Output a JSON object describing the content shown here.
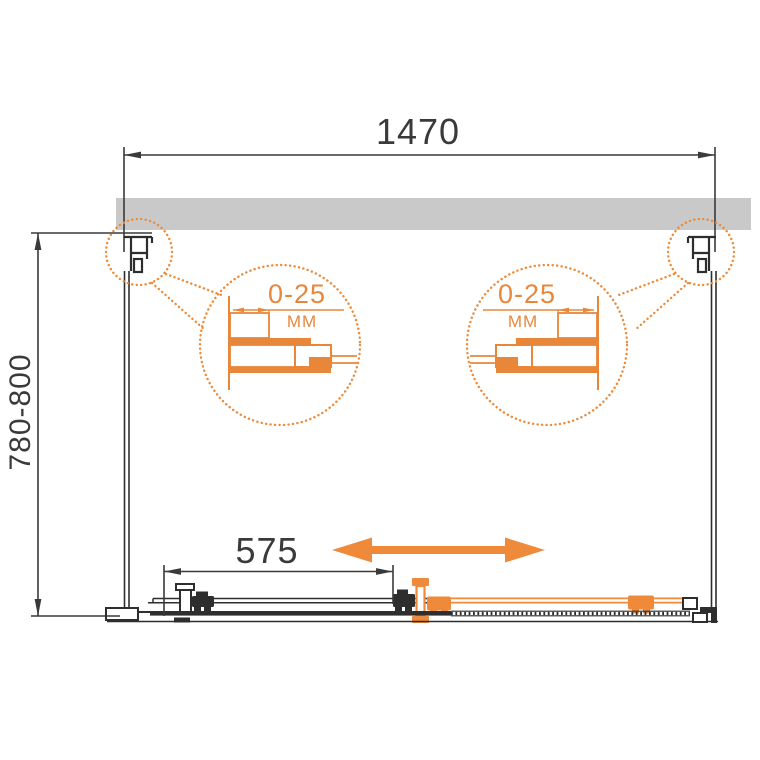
{
  "drawing": {
    "type": "shower-enclosure-plan-view-technical-drawing",
    "dimensions": {
      "width": {
        "label": "1470"
      },
      "depth": {
        "label": "780-800"
      },
      "door_travel": {
        "label": "575"
      }
    },
    "details": [
      {
        "id": "left-wall-profile-adjustment",
        "range": "0-25",
        "unit": "ММ"
      },
      {
        "id": "right-wall-profile-adjustment",
        "range": "0-25",
        "unit": "ММ"
      }
    ],
    "icons": [
      "slide-direction-arrow-icon",
      "callout-circle-icon",
      "magnified-detail-circle-icon"
    ],
    "colors": {
      "accent_orange": "#EF8A3A",
      "line_dark": "#2e2e2e",
      "dim_text": "#3a3a3a",
      "wall_gray": "#C9C9C9"
    }
  }
}
